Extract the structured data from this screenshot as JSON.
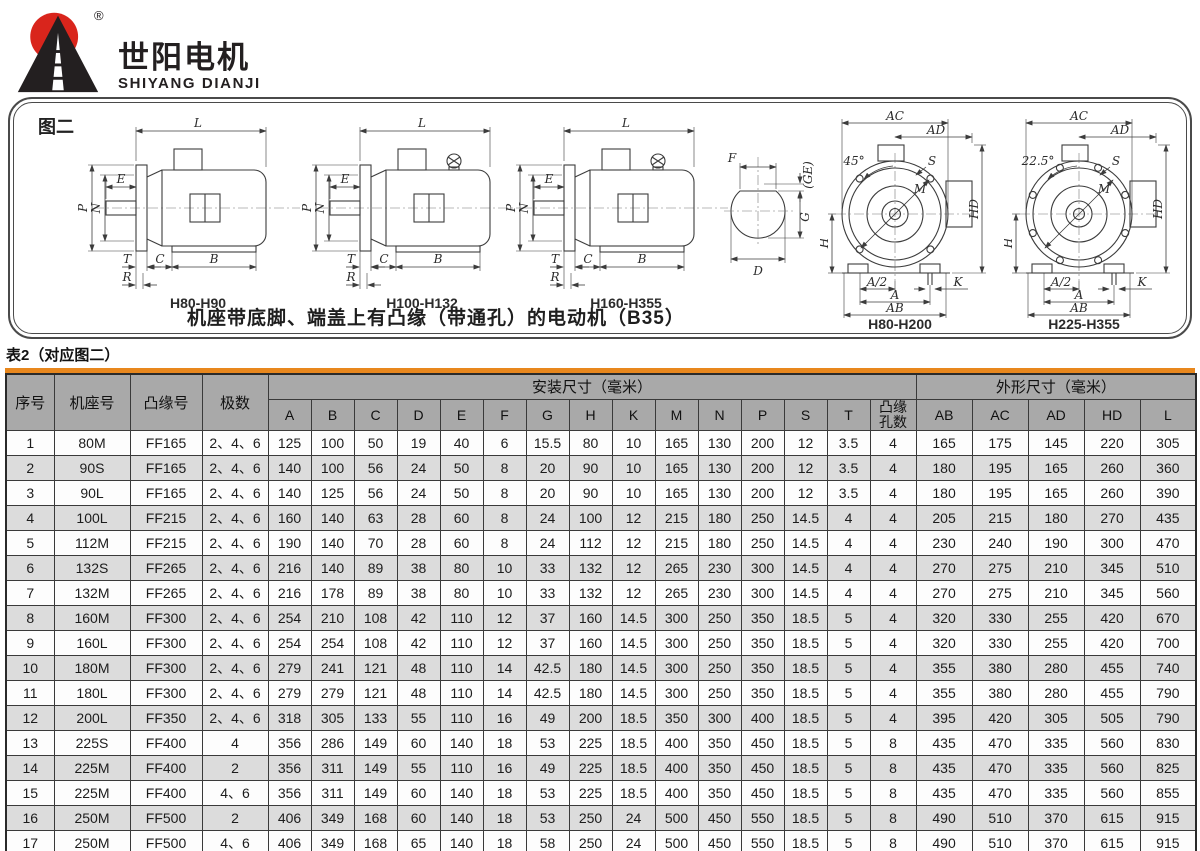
{
  "brand": {
    "name_cn": "世阳电机",
    "name_en": "SHIYANG DIANJI",
    "reg": "®"
  },
  "figure": {
    "label": "图二",
    "caption": "机座带底脚、端盖上有凸缘（带通孔）的电动机（B35）",
    "captions": {
      "side1": "H80-H90",
      "side2": "H100-H132",
      "side3": "H160-H355",
      "front1": "H80-H200",
      "front2": "H225-H355"
    },
    "dims": {
      "L": "L",
      "E": "E",
      "P": "P",
      "N": "N",
      "T": "T",
      "R": "R",
      "C": "C",
      "B": "B",
      "F": "F",
      "GE": "(GE)",
      "G": "G",
      "D": "D",
      "AC": "AC",
      "AD": "AD",
      "HD": "HD",
      "H": "H",
      "A2": "A/2",
      "A": "A",
      "AB": "AB",
      "K": "K",
      "M": "M",
      "S": "S",
      "angle1": "45°",
      "angle2": "22.5°"
    }
  },
  "table": {
    "title": "表2（对应图二）",
    "col_headers_fixed": [
      "序号",
      "机座号",
      "凸缘号",
      "极数"
    ],
    "group_install": "安装尺寸（毫米）",
    "group_outline": "外形尺寸（毫米）",
    "install_cols": [
      "A",
      "B",
      "C",
      "D",
      "E",
      "F",
      "G",
      "H",
      "K",
      "M",
      "N",
      "P",
      "S",
      "T",
      "凸缘孔数"
    ],
    "outline_cols": [
      "AB",
      "AC",
      "AD",
      "HD",
      "L"
    ],
    "rows": [
      [
        "1",
        "80M",
        "FF165",
        "2、4、6",
        "125",
        "100",
        "50",
        "19",
        "40",
        "6",
        "15.5",
        "80",
        "10",
        "165",
        "130",
        "200",
        "12",
        "3.5",
        "4",
        "165",
        "175",
        "145",
        "220",
        "305"
      ],
      [
        "2",
        "90S",
        "FF165",
        "2、4、6",
        "140",
        "100",
        "56",
        "24",
        "50",
        "8",
        "20",
        "90",
        "10",
        "165",
        "130",
        "200",
        "12",
        "3.5",
        "4",
        "180",
        "195",
        "165",
        "260",
        "360"
      ],
      [
        "3",
        "90L",
        "FF165",
        "2、4、6",
        "140",
        "125",
        "56",
        "24",
        "50",
        "8",
        "20",
        "90",
        "10",
        "165",
        "130",
        "200",
        "12",
        "3.5",
        "4",
        "180",
        "195",
        "165",
        "260",
        "390"
      ],
      [
        "4",
        "100L",
        "FF215",
        "2、4、6",
        "160",
        "140",
        "63",
        "28",
        "60",
        "8",
        "24",
        "100",
        "12",
        "215",
        "180",
        "250",
        "14.5",
        "4",
        "4",
        "205",
        "215",
        "180",
        "270",
        "435"
      ],
      [
        "5",
        "112M",
        "FF215",
        "2、4、6",
        "190",
        "140",
        "70",
        "28",
        "60",
        "8",
        "24",
        "112",
        "12",
        "215",
        "180",
        "250",
        "14.5",
        "4",
        "4",
        "230",
        "240",
        "190",
        "300",
        "470"
      ],
      [
        "6",
        "132S",
        "FF265",
        "2、4、6",
        "216",
        "140",
        "89",
        "38",
        "80",
        "10",
        "33",
        "132",
        "12",
        "265",
        "230",
        "300",
        "14.5",
        "4",
        "4",
        "270",
        "275",
        "210",
        "345",
        "510"
      ],
      [
        "7",
        "132M",
        "FF265",
        "2、4、6",
        "216",
        "178",
        "89",
        "38",
        "80",
        "10",
        "33",
        "132",
        "12",
        "265",
        "230",
        "300",
        "14.5",
        "4",
        "4",
        "270",
        "275",
        "210",
        "345",
        "560"
      ],
      [
        "8",
        "160M",
        "FF300",
        "2、4、6",
        "254",
        "210",
        "108",
        "42",
        "110",
        "12",
        "37",
        "160",
        "14.5",
        "300",
        "250",
        "350",
        "18.5",
        "5",
        "4",
        "320",
        "330",
        "255",
        "420",
        "670"
      ],
      [
        "9",
        "160L",
        "FF300",
        "2、4、6",
        "254",
        "254",
        "108",
        "42",
        "110",
        "12",
        "37",
        "160",
        "14.5",
        "300",
        "250",
        "350",
        "18.5",
        "5",
        "4",
        "320",
        "330",
        "255",
        "420",
        "700"
      ],
      [
        "10",
        "180M",
        "FF300",
        "2、4、6",
        "279",
        "241",
        "121",
        "48",
        "110",
        "14",
        "42.5",
        "180",
        "14.5",
        "300",
        "250",
        "350",
        "18.5",
        "5",
        "4",
        "355",
        "380",
        "280",
        "455",
        "740"
      ],
      [
        "11",
        "180L",
        "FF300",
        "2、4、6",
        "279",
        "279",
        "121",
        "48",
        "110",
        "14",
        "42.5",
        "180",
        "14.5",
        "300",
        "250",
        "350",
        "18.5",
        "5",
        "4",
        "355",
        "380",
        "280",
        "455",
        "790"
      ],
      [
        "12",
        "200L",
        "FF350",
        "2、4、6",
        "318",
        "305",
        "133",
        "55",
        "110",
        "16",
        "49",
        "200",
        "18.5",
        "350",
        "300",
        "400",
        "18.5",
        "5",
        "4",
        "395",
        "420",
        "305",
        "505",
        "790"
      ],
      [
        "13",
        "225S",
        "FF400",
        "4",
        "356",
        "286",
        "149",
        "60",
        "140",
        "18",
        "53",
        "225",
        "18.5",
        "400",
        "350",
        "450",
        "18.5",
        "5",
        "8",
        "435",
        "470",
        "335",
        "560",
        "830"
      ],
      [
        "14",
        "225M",
        "FF400",
        "2",
        "356",
        "311",
        "149",
        "55",
        "110",
        "16",
        "49",
        "225",
        "18.5",
        "400",
        "350",
        "450",
        "18.5",
        "5",
        "8",
        "435",
        "470",
        "335",
        "560",
        "825"
      ],
      [
        "15",
        "225M",
        "FF400",
        "4、6",
        "356",
        "311",
        "149",
        "60",
        "140",
        "18",
        "53",
        "225",
        "18.5",
        "400",
        "350",
        "450",
        "18.5",
        "5",
        "8",
        "435",
        "470",
        "335",
        "560",
        "855"
      ],
      [
        "16",
        "250M",
        "FF500",
        "2",
        "406",
        "349",
        "168",
        "60",
        "140",
        "18",
        "53",
        "250",
        "24",
        "500",
        "450",
        "550",
        "18.5",
        "5",
        "8",
        "490",
        "510",
        "370",
        "615",
        "915"
      ],
      [
        "17",
        "250M",
        "FF500",
        "4、6",
        "406",
        "349",
        "168",
        "65",
        "140",
        "18",
        "58",
        "250",
        "24",
        "500",
        "450",
        "550",
        "18.5",
        "5",
        "8",
        "490",
        "510",
        "370",
        "615",
        "915"
      ]
    ]
  },
  "colors": {
    "accent_orange": "#E8871D",
    "header_gray": "#A9A9A9",
    "stripe_gray": "#DCDCDC",
    "logo_red": "#D9251C"
  }
}
